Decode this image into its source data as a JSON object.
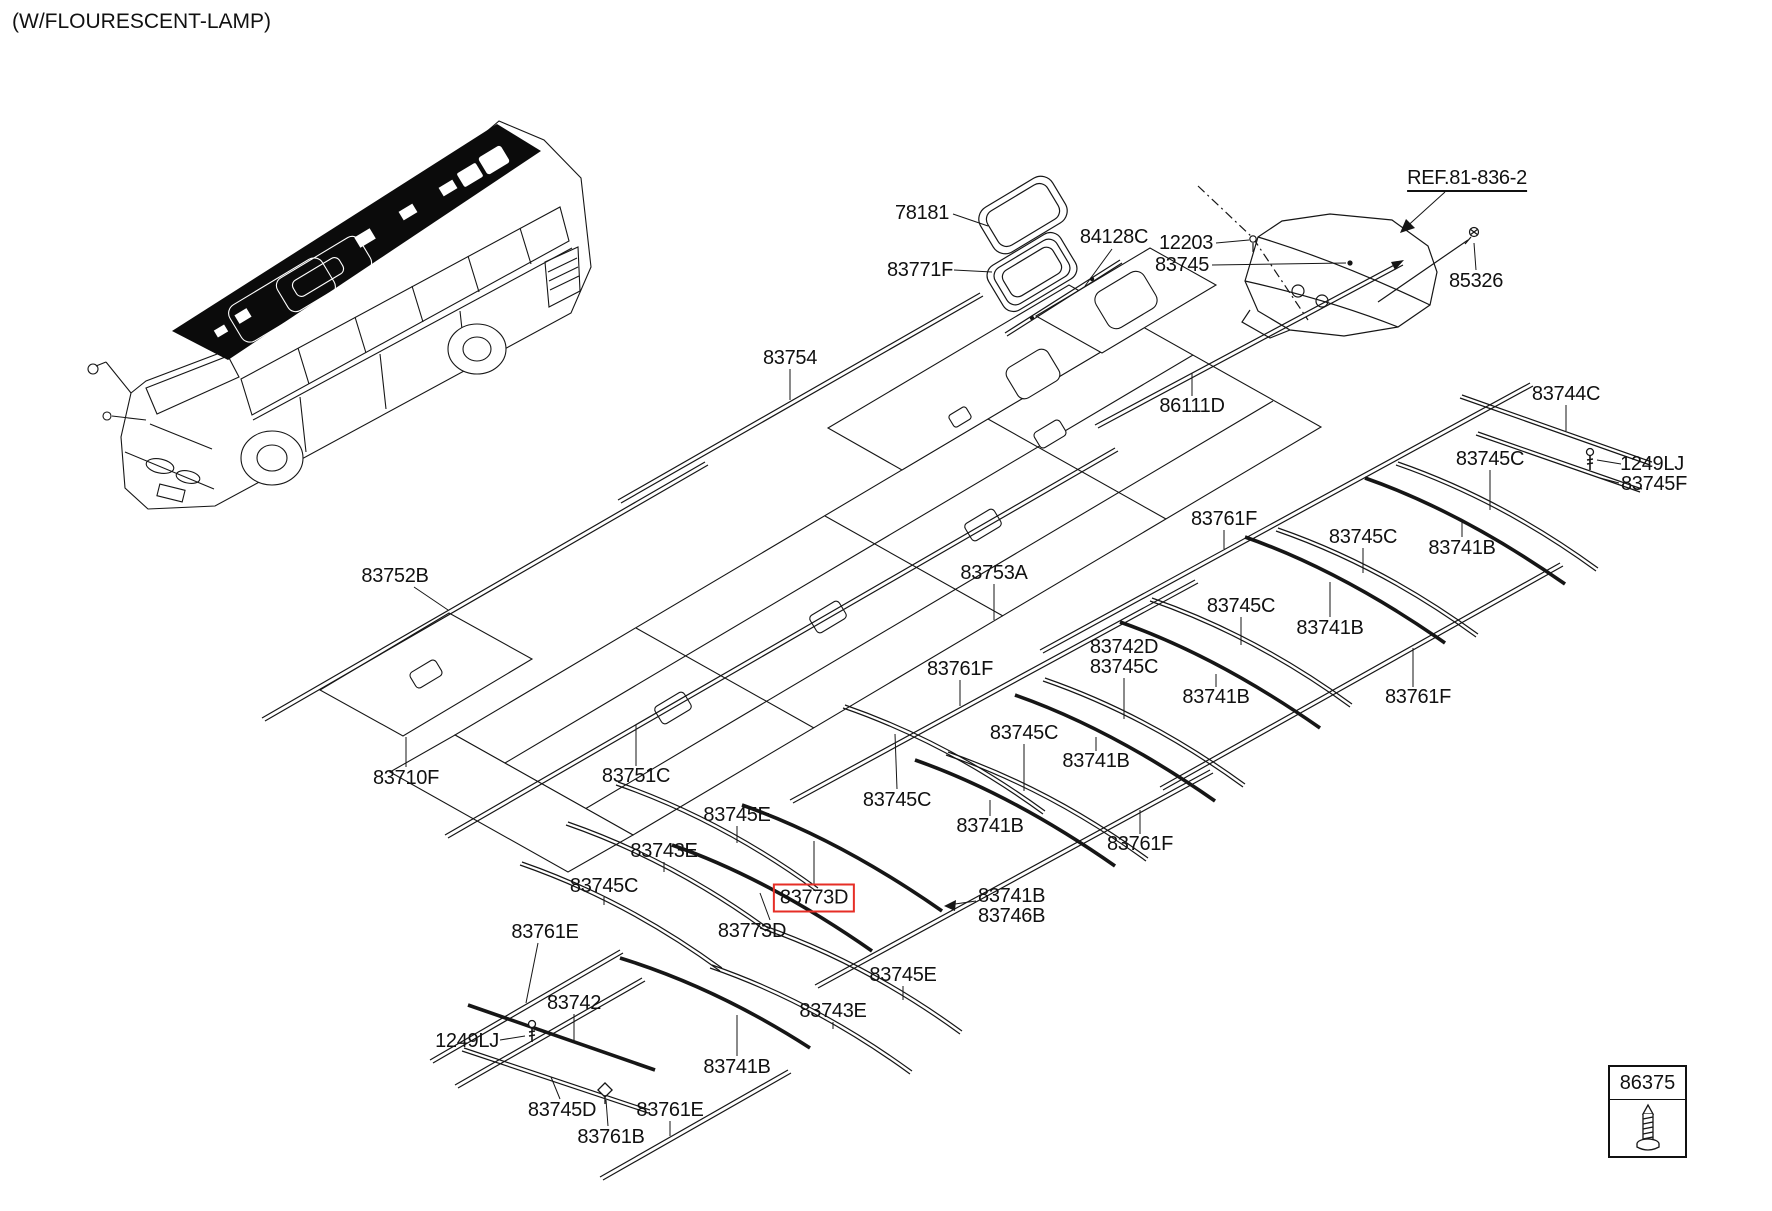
{
  "title": "(W/FLOURESCENT-LAMP)",
  "highlight_color": "#e62e26",
  "legend": {
    "part_no": "86375"
  },
  "labels": [
    {
      "id": "78181",
      "text": "78181",
      "x": 922,
      "y": 213
    },
    {
      "id": "83771F",
      "text": "83771F",
      "x": 920,
      "y": 270
    },
    {
      "id": "84128C",
      "text": "84128C",
      "x": 1114,
      "y": 237
    },
    {
      "id": "12203",
      "text": "12203",
      "x": 1186,
      "y": 243
    },
    {
      "id": "83745",
      "text": "83745",
      "x": 1182,
      "y": 265
    },
    {
      "id": "ref-81-836-2",
      "text": "REF.81-836-2",
      "x": 1467,
      "y": 180,
      "style": "underlined"
    },
    {
      "id": "85326",
      "text": "85326",
      "x": 1476,
      "y": 281
    },
    {
      "id": "83754",
      "text": "83754",
      "x": 790,
      "y": 358
    },
    {
      "id": "86111D",
      "text": "86111D",
      "x": 1192,
      "y": 406
    },
    {
      "id": "83744C",
      "text": "83744C",
      "x": 1566,
      "y": 394
    },
    {
      "id": "83745C-a",
      "text": "83745C",
      "x": 1490,
      "y": 459
    },
    {
      "id": "1249LJ-a",
      "text": "1249LJ",
      "x": 1652,
      "y": 464
    },
    {
      "id": "83745F",
      "text": "83745F",
      "x": 1654,
      "y": 484
    },
    {
      "id": "83761F-a",
      "text": "83761F",
      "x": 1224,
      "y": 519
    },
    {
      "id": "83745C-b",
      "text": "83745C",
      "x": 1363,
      "y": 537
    },
    {
      "id": "83741B-a",
      "text": "83741B",
      "x": 1462,
      "y": 548
    },
    {
      "id": "83752B",
      "text": "83752B",
      "x": 395,
      "y": 576
    },
    {
      "id": "83753A",
      "text": "83753A",
      "x": 994,
      "y": 573
    },
    {
      "id": "83745C-c",
      "text": "83745C",
      "x": 1241,
      "y": 606
    },
    {
      "id": "83741B-b",
      "text": "83741B",
      "x": 1330,
      "y": 628
    },
    {
      "id": "83742D",
      "text": "83742D",
      "x": 1124,
      "y": 647
    },
    {
      "id": "83745C-d",
      "text": "83745C",
      "x": 1124,
      "y": 667
    },
    {
      "id": "83761F-b",
      "text": "83761F",
      "x": 960,
      "y": 669
    },
    {
      "id": "83741B-c",
      "text": "83741B",
      "x": 1216,
      "y": 697
    },
    {
      "id": "83761F-c",
      "text": "83761F",
      "x": 1418,
      "y": 697
    },
    {
      "id": "83745C-e",
      "text": "83745C",
      "x": 1024,
      "y": 733
    },
    {
      "id": "83741B-d",
      "text": "83741B",
      "x": 1096,
      "y": 761
    },
    {
      "id": "83710F",
      "text": "83710F",
      "x": 406,
      "y": 778
    },
    {
      "id": "83751C",
      "text": "83751C",
      "x": 636,
      "y": 776
    },
    {
      "id": "83745C-f",
      "text": "83745C",
      "x": 897,
      "y": 800
    },
    {
      "id": "83745E-a",
      "text": "83745E",
      "x": 737,
      "y": 815
    },
    {
      "id": "83741B-e",
      "text": "83741B",
      "x": 990,
      "y": 826
    },
    {
      "id": "83761F-d",
      "text": "83761F",
      "x": 1140,
      "y": 844
    },
    {
      "id": "83743E-a",
      "text": "83743E",
      "x": 664,
      "y": 851
    },
    {
      "id": "83745C-g",
      "text": "83745C",
      "x": 604,
      "y": 886
    },
    {
      "id": "83773D-highlight",
      "text": "83773D",
      "x": 814,
      "y": 898,
      "style": "boxed"
    },
    {
      "id": "83741B-f",
      "text": "83741B",
      "x": 978,
      "y": 896,
      "align": "left"
    },
    {
      "id": "83746B",
      "text": "83746B",
      "x": 978,
      "y": 916,
      "align": "left"
    },
    {
      "id": "83773D",
      "text": "83773D",
      "x": 752,
      "y": 931
    },
    {
      "id": "83761E-a",
      "text": "83761E",
      "x": 545,
      "y": 932
    },
    {
      "id": "83745E-b",
      "text": "83745E",
      "x": 903,
      "y": 975
    },
    {
      "id": "83742",
      "text": "83742",
      "x": 574,
      "y": 1003
    },
    {
      "id": "83743E-b",
      "text": "83743E",
      "x": 833,
      "y": 1011
    },
    {
      "id": "1249LJ-b",
      "text": "1249LJ",
      "x": 467,
      "y": 1041
    },
    {
      "id": "83741B-g",
      "text": "83741B",
      "x": 737,
      "y": 1067
    },
    {
      "id": "83745D",
      "text": "83745D",
      "x": 562,
      "y": 1110
    },
    {
      "id": "83761E-b",
      "text": "83761E",
      "x": 670,
      "y": 1110
    },
    {
      "id": "83761B",
      "text": "83761B",
      "x": 611,
      "y": 1137
    }
  ]
}
